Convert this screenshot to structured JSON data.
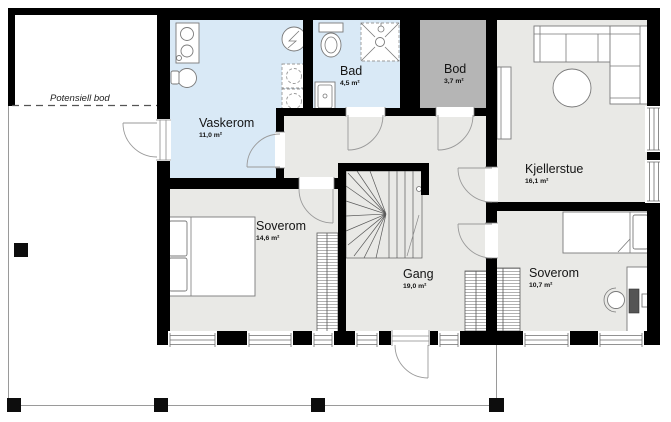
{
  "plan": {
    "title": "Basement floor plan",
    "rooms": {
      "potensiell_bod": {
        "name": "Potensiell bod",
        "area": ""
      },
      "vaskerom": {
        "name": "Vaskerom",
        "area": "11,0 m²"
      },
      "bad": {
        "name": "Bad",
        "area": "4,5 m²"
      },
      "bod": {
        "name": "Bod",
        "area": "3,7 m²"
      },
      "kjellerstue": {
        "name": "Kjellerstue",
        "area": "16,1 m²"
      },
      "soverom_1": {
        "name": "Soverom",
        "area": "14,6 m²"
      },
      "gang": {
        "name": "Gang",
        "area": "19,0 m²"
      },
      "soverom_2": {
        "name": "Soverom",
        "area": "10,7 m²"
      }
    },
    "colors": {
      "wet_room": "#d9e9f6",
      "storage": "#b5b5b5",
      "room": "#e9e9e6",
      "wall": "#000000"
    }
  }
}
